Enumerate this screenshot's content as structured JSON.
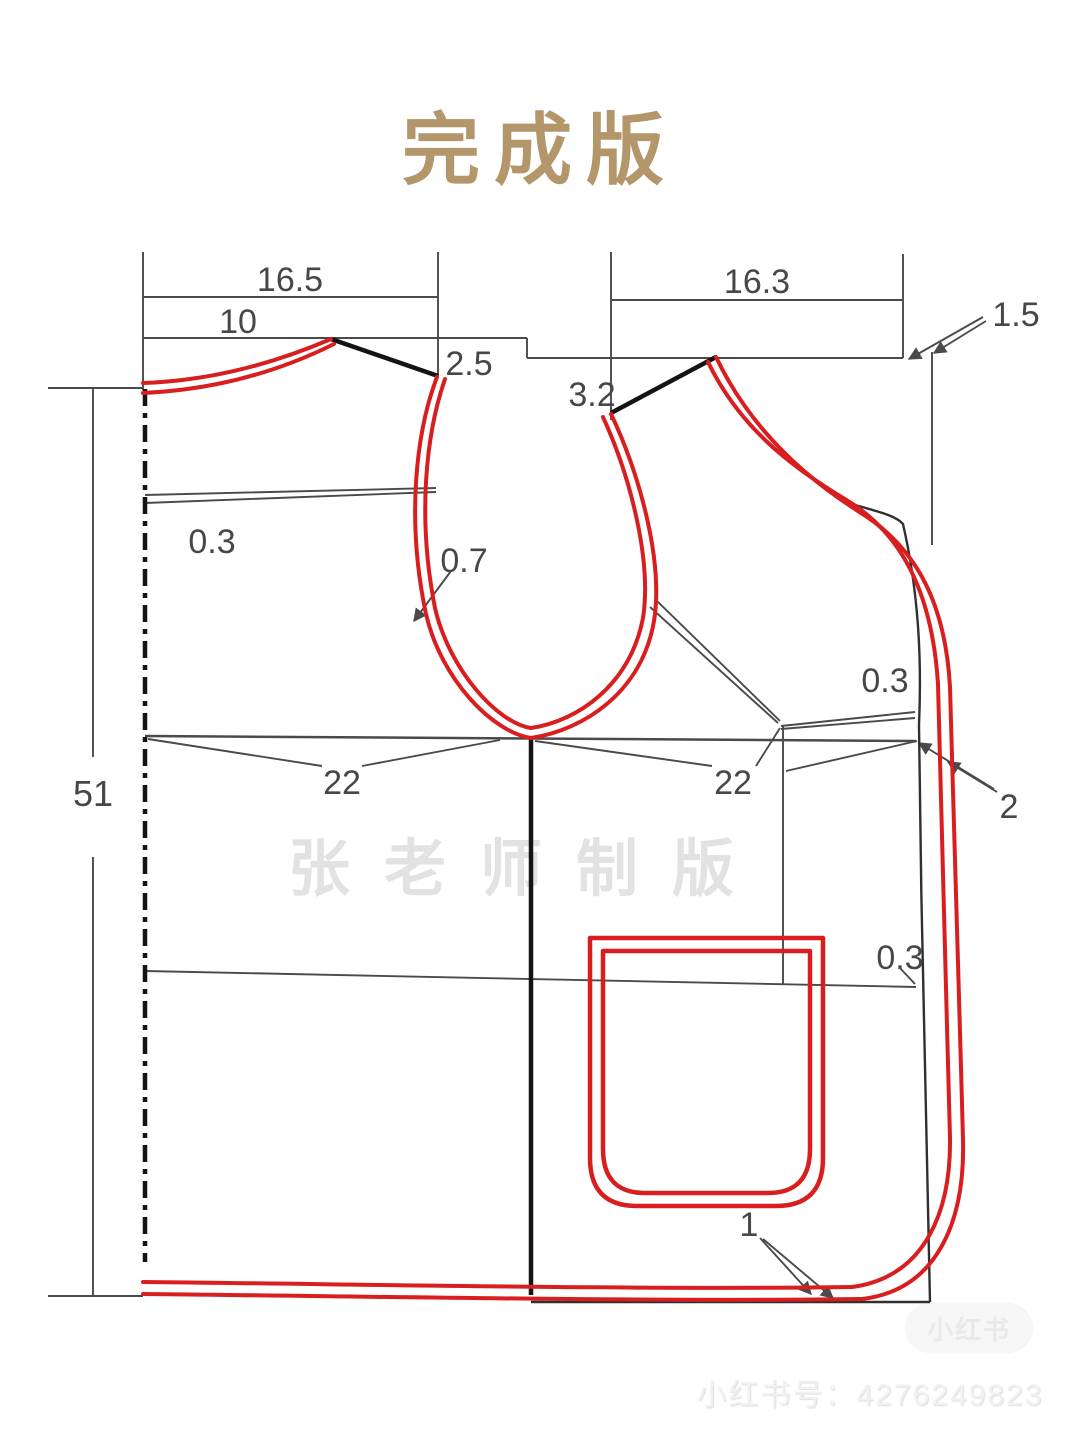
{
  "page": {
    "title": "完成版"
  },
  "watermarks": {
    "center": "张老师制版",
    "footer": "小红书号：4276249823",
    "badge": "小红书"
  },
  "colors": {
    "title_gold": "#b3976b",
    "pattern_red": "#d81e1e",
    "construction_gray": "#4a4a4a",
    "seam_black": "#141414",
    "watermark_gray": "#e2e2e2"
  },
  "labels": {
    "top_width_left": "16.5",
    "neck_width": "10",
    "shoulder_drop_left": "2.5",
    "shoulder_drop_right": "3.2",
    "top_width_right": "16.3",
    "back_neck_offset": "1.5",
    "neck_adjust": "0.3",
    "armhole_adjust": "0.7",
    "side_adjust": "0.3",
    "front_edge_out": "2",
    "body_length": "51",
    "chest_left": "22",
    "chest_right": "22",
    "pocket_line_adjust": "0.3",
    "hem_adjust": "1"
  }
}
